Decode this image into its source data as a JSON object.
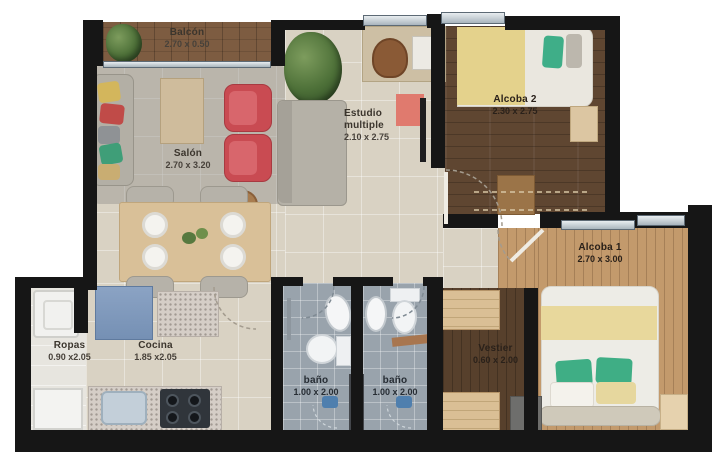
{
  "plan": {
    "type": "apartment-floor-plan",
    "rooms": [
      {
        "id": "balcon",
        "name": "Balcón",
        "dims": "2.70 x 0.50"
      },
      {
        "id": "salon",
        "name": "Salón",
        "dims": "2.70 x 3.20"
      },
      {
        "id": "estudio",
        "name_line1": "Estudio",
        "name_line2": "multiple",
        "dims": "2.10 x 2.75"
      },
      {
        "id": "alcoba2",
        "name": "Alcoba 2",
        "dims": "2.30 x 2.75"
      },
      {
        "id": "alcoba1",
        "name": "Alcoba 1",
        "dims": "2.70 x 3.00"
      },
      {
        "id": "ropas",
        "name": "Ropas",
        "dims": "0.90 x2.05"
      },
      {
        "id": "cocina",
        "name": "Cocina",
        "dims": "1.85 x2.05"
      },
      {
        "id": "bano1",
        "name": "baño",
        "dims": "1.00 x 2.00"
      },
      {
        "id": "bano2",
        "name": "baño",
        "dims": "1.00 x 2.00"
      },
      {
        "id": "vestier",
        "name": "Vestier",
        "dims": "0.60 x 2.00"
      }
    ],
    "colors": {
      "wall": "#161616",
      "floor_main": "#d9d2c3",
      "wood_dark": "#5f4631",
      "wood_light": "#c39a6c",
      "balcony_deck": "#7d5c41",
      "bath_tile": "#99a3ac",
      "accent_red": "#c94b52",
      "accent_blue": "#7590b4",
      "accent_green": "#3fae85",
      "accent_yellow": "#e4d28c",
      "label_text": "#3b352d"
    }
  }
}
